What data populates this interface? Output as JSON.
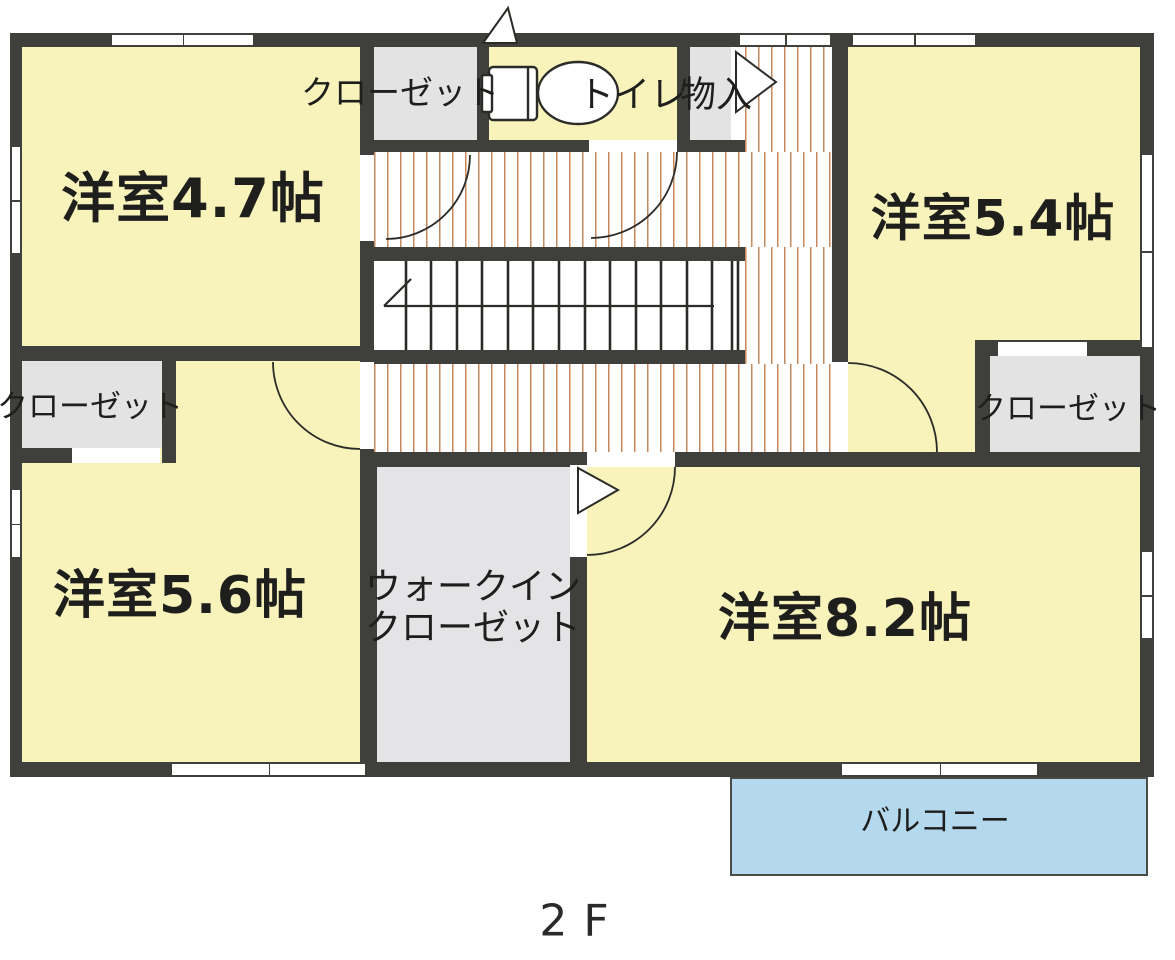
{
  "floor": {
    "title": "2F"
  },
  "rooms": {
    "room_top_left": {
      "label": "洋室4.7帖"
    },
    "room_top_right": {
      "label": "洋室5.4帖"
    },
    "room_bottom_left": {
      "label": "洋室5.6帖"
    },
    "room_bottom_right": {
      "label": "洋室8.2帖"
    },
    "closet_top": {
      "label": "クローゼット"
    },
    "closet_left": {
      "label": "クローゼット"
    },
    "closet_right": {
      "label": "クローゼット"
    },
    "toilet": {
      "label": "トイレ"
    },
    "storage": {
      "label": "物入"
    },
    "walk_in_closet": {
      "line1": "ウォークイン",
      "line2": "クローゼット"
    },
    "balcony": {
      "label": "バルコニー"
    }
  },
  "colors": {
    "wall": "#3f3f3c",
    "room_fill": "#f8f2bb",
    "closet_fill": "#e3e3e3",
    "walk_in_closet_fill": "#e4e4e7",
    "hall_stripe": "#c2895e",
    "balcony_fill": "#b4d8ee",
    "line": "#2b2b28"
  }
}
